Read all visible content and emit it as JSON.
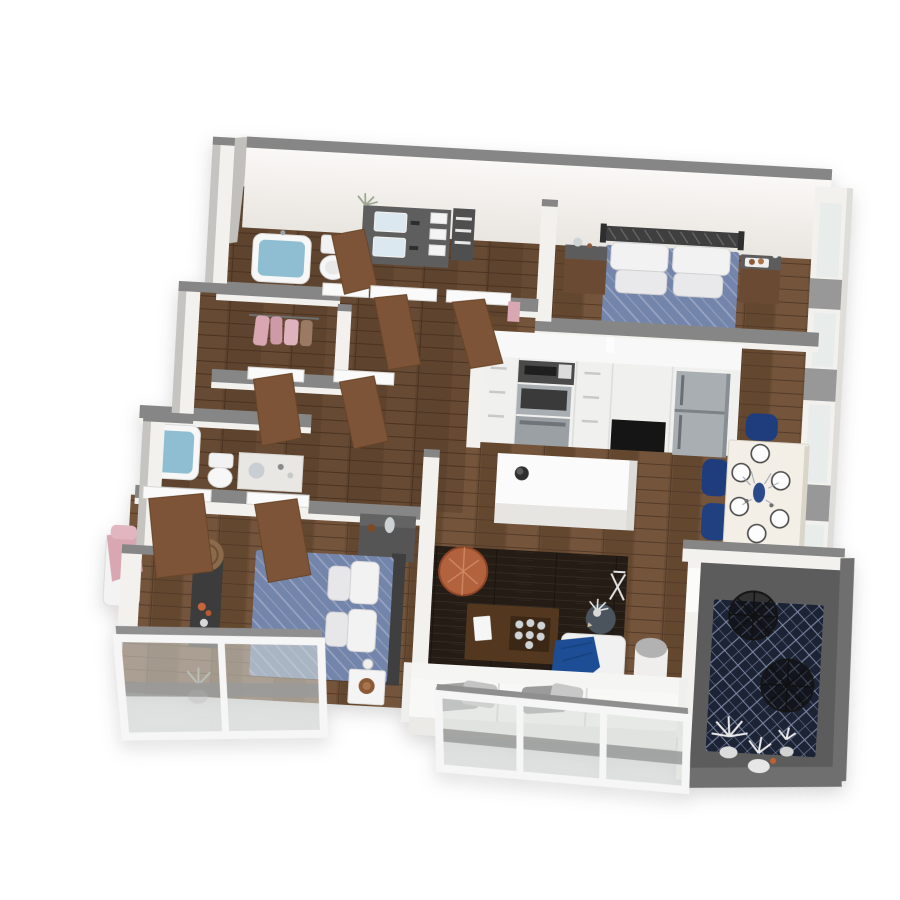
{
  "meta": {
    "type": "3d-floor-plan-render",
    "view": "isometric top-down dollhouse view",
    "description": "Photorealistic 3D floor plan of a two-bedroom, two-bathroom apartment with open kitchen, living-dining area and corner balcony"
  },
  "palette": {
    "background": "#ffffff",
    "wood_floor": "#6b4e36",
    "wood_floor_shadow": "#543b28",
    "wall_face_white": "#f3f1ee",
    "wall_cap_gray": "#868686",
    "bedding_blue": "#7485ab",
    "bedding_grid": "#9da8c6",
    "pillow_white": "#f2f2f2",
    "navy_chair": "#1f3d7c",
    "throw_blue": "#1d4d94",
    "living_rug_brown": "#241c15",
    "balcony_rug_navy": "#1c2335",
    "balcony_floor_gray": "#5c5c5c",
    "tub_water_blue": "#8fbdd1",
    "door_wood_brown": "#7e5438",
    "pouf_orange": "#b66a45",
    "stainless_steel": "#a9aeb3",
    "closet_clothes_pink": "#d8a7b2",
    "dining_table_cream": "#f3efe6"
  },
  "rooms": [
    {
      "name": "master-bedroom",
      "aria": "Master bedroom with double bed, metal headboard and two nightstands"
    },
    {
      "name": "kitchen",
      "aria": "Kitchen with white cabinets, wall oven, refrigerator and island"
    },
    {
      "name": "dining-area",
      "aria": "Dining area with table set for six and navy chairs"
    },
    {
      "name": "living-room",
      "aria": "Living room with dark rug, coffee table, pouf, lounge chair and sofa"
    },
    {
      "name": "second-bedroom",
      "aria": "Second bedroom with double bed, dresser and console"
    },
    {
      "name": "master-bathroom",
      "aria": "Master bathroom with filled tub, toilet and double vanity"
    },
    {
      "name": "second-bathroom",
      "aria": "Second bathroom with filled tub, toilet and vanity"
    },
    {
      "name": "walk-in-closet",
      "aria": "Walk-in closet with pink clothes hanging"
    },
    {
      "name": "balcony",
      "aria": "Corner balcony with navy patterned rug, wire chairs and white plants"
    },
    {
      "name": "window-wall",
      "aria": "Floor-to-ceiling window walls along the lower facade"
    }
  ],
  "furniture": [
    "blue diamond-quilt double bed with four white pillows (master bedroom)",
    "dark metal slatted headboard",
    "two wood nightstands with decor trays",
    "white kitchen counter run with range hood, stainless wall oven, black appliance front and stainless refrigerator",
    "white kitchen island with black bowl",
    "cream dining table with six place settings and blue vase centerpiece",
    "four navy upholstered dining chairs",
    "dark brown area rug",
    "walnut coffee table with tray, bowls and white notebook",
    "orange leather pouf",
    "round charcoal side table with white plant",
    "white lounge chair with navy throw",
    "white cylinder floor lamp",
    "white three-seat sofa with gray pillows",
    "blue diamond-quilt double bed (second bedroom)",
    "gray dresser with glass vase",
    "black console with orange flowers and round wood stool",
    "white nightstand with wood tray and sphere lamp",
    "two soaking tubs filled with water",
    "two toilets",
    "dark double vanity with towel shelf",
    "pink-draped chaise",
    "hanging pink clothes in closet",
    "navy ikat balcony rug",
    "two black wire lounge chairs",
    "white plants in planters",
    "eight open wood interior doors"
  ]
}
